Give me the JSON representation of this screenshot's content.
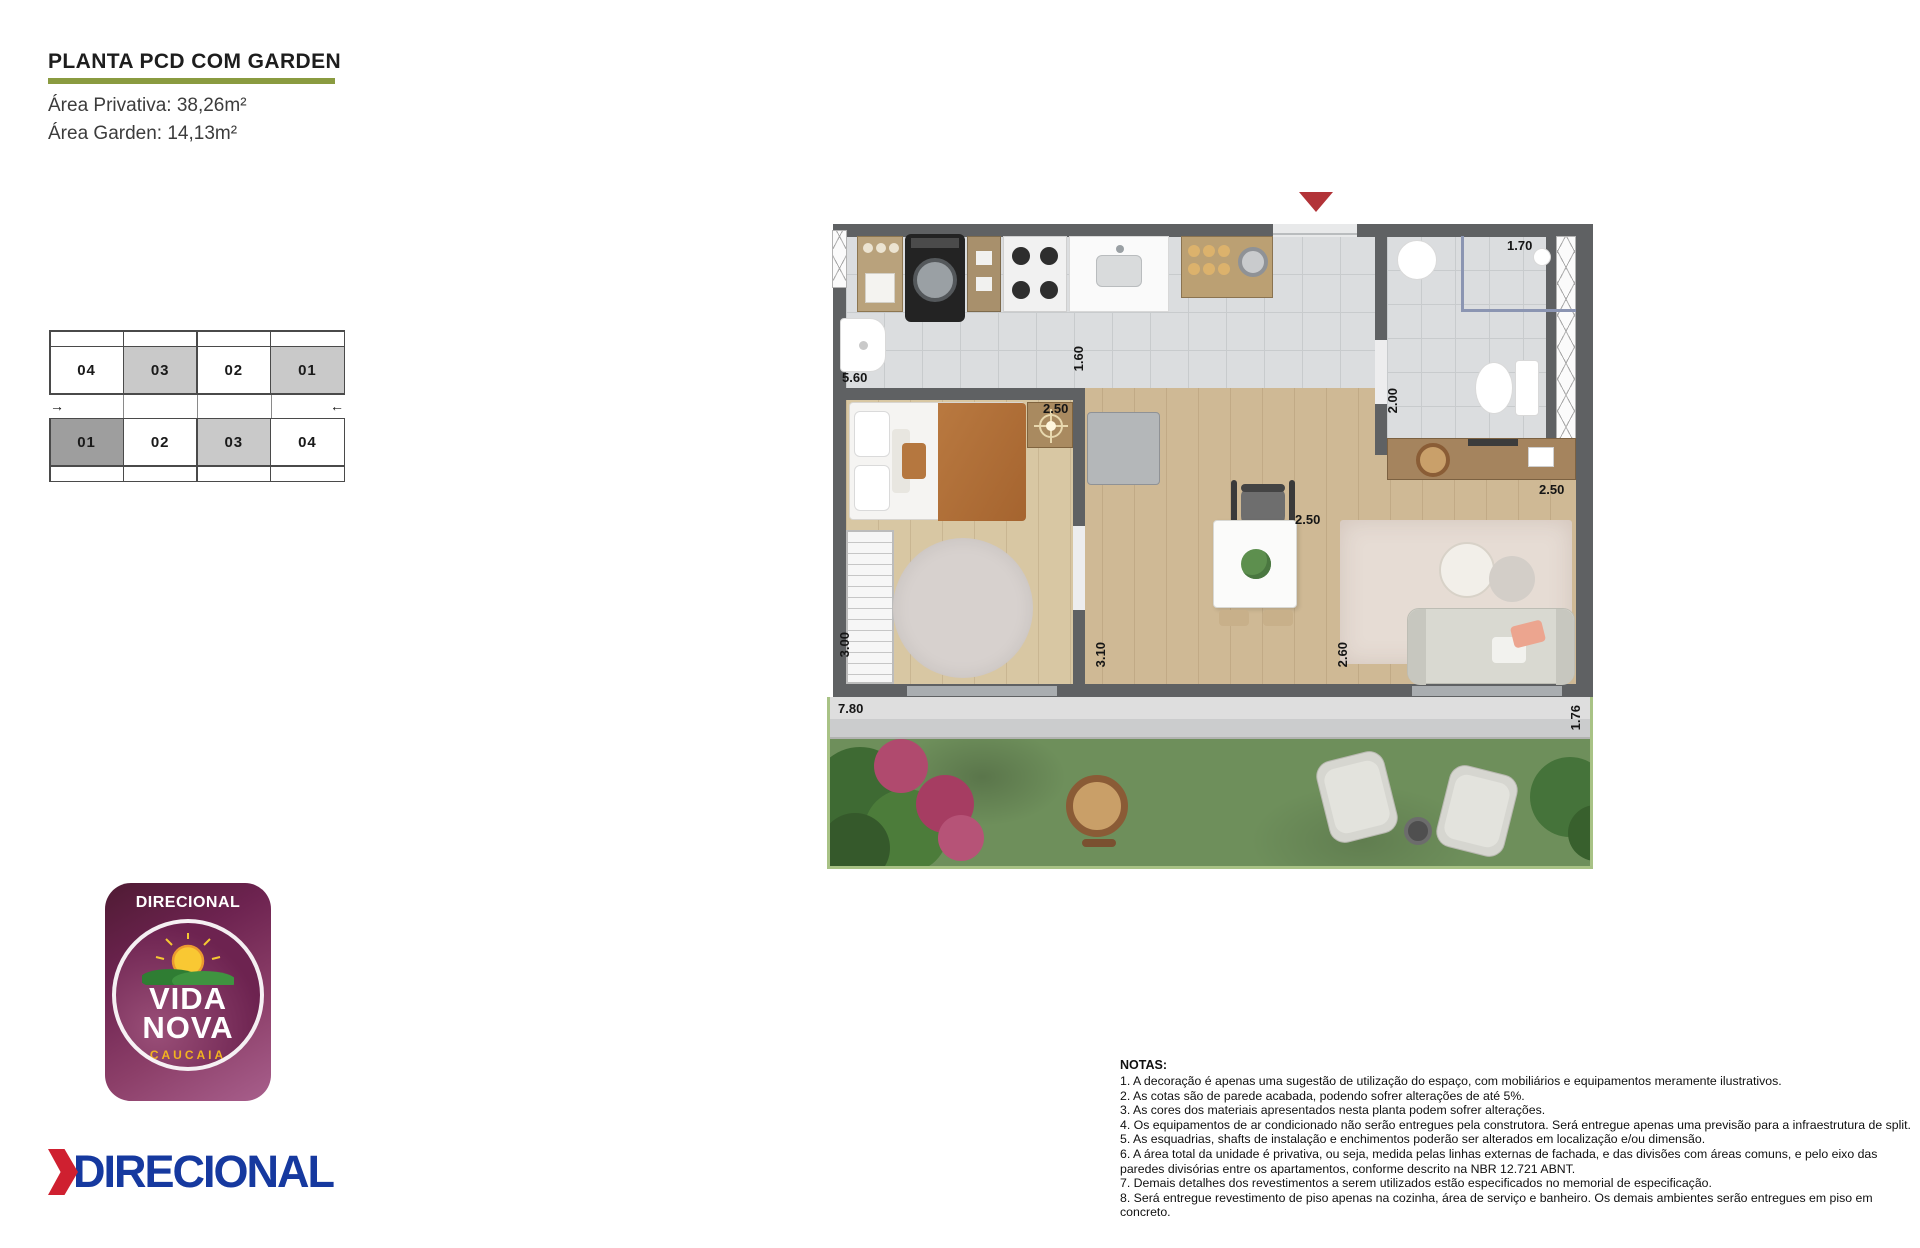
{
  "header": {
    "title": "PLANTA PCD COM GARDEN",
    "area_privativa": "Área Privativa: 38,26m²",
    "area_garden": "Área Garden: 14,13m²"
  },
  "key_plan": {
    "upper_row": [
      "04",
      "03",
      "02",
      "01"
    ],
    "lower_row": [
      "01",
      "02",
      "03",
      "04"
    ],
    "left_arrow": "→",
    "right_arrow": "←"
  },
  "floor_plan": {
    "dimensions": {
      "service_width": "5.60",
      "kitchen_depth": "1.60",
      "shower_width": "1.70",
      "bath_depth": "2.00",
      "bedroom_width": "2.50",
      "dining_width": "2.50",
      "living_width": "2.50",
      "bedroom_depth": "3.00",
      "hall_depth": "3.10",
      "living_depth": "2.60",
      "garden_width": "7.80",
      "garden_depth": "1.76"
    }
  },
  "logos": {
    "badge": {
      "brand": "DIRECIONAL",
      "line1": "VIDA",
      "line2": "NOVA",
      "city": "CAUCAIA"
    },
    "wordmark": "DIRECIONAL"
  },
  "notes": {
    "title": "NOTAS:",
    "items": [
      "1. A decoração é apenas uma sugestão de utilização do espaço, com mobiliários e equipamentos meramente ilustrativos.",
      "2. As cotas são de parede acabada, podendo sofrer alterações de até 5%.",
      "3. As cores dos materiais apresentados nesta planta podem sofrer alterações.",
      "4. Os equipamentos de ar condicionado não serão entregues pela construtora. Será entregue apenas uma previsão para a infraestrutura de split.",
      "5. As esquadrias, shafts de instalação e enchimentos poderão ser alterados em localização e/ou dimensão.",
      "6. A área total da unidade é privativa, ou seja, medida pelas linhas externas de fachada, e das divisões com áreas comuns, e pelo eixo das paredes divisórias entre os apartamentos, conforme descrito na NBR 12.721 ABNT.",
      "7. Demais detalhes dos revestimentos a serem utilizados estão especificados no memorial de especificação.",
      "8. Será entregue revestimento de piso apenas na cozinha, área de serviço e banheiro. Os demais ambientes serão entregues em piso em concreto."
    ]
  },
  "colors": {
    "accent_olive": "#8a9b40",
    "brand_blue": "#16399f",
    "brand_red": "#cf2030",
    "caucaia_yellow": "#f2b31f",
    "entry_marker_red": "#b23338",
    "grass_green": "#6e8f5b",
    "garden_border_green": "#a8c285",
    "wall_gray": "#5f6163",
    "cell_light": "#c9c9c9",
    "cell_dark": "#9e9e9e"
  }
}
